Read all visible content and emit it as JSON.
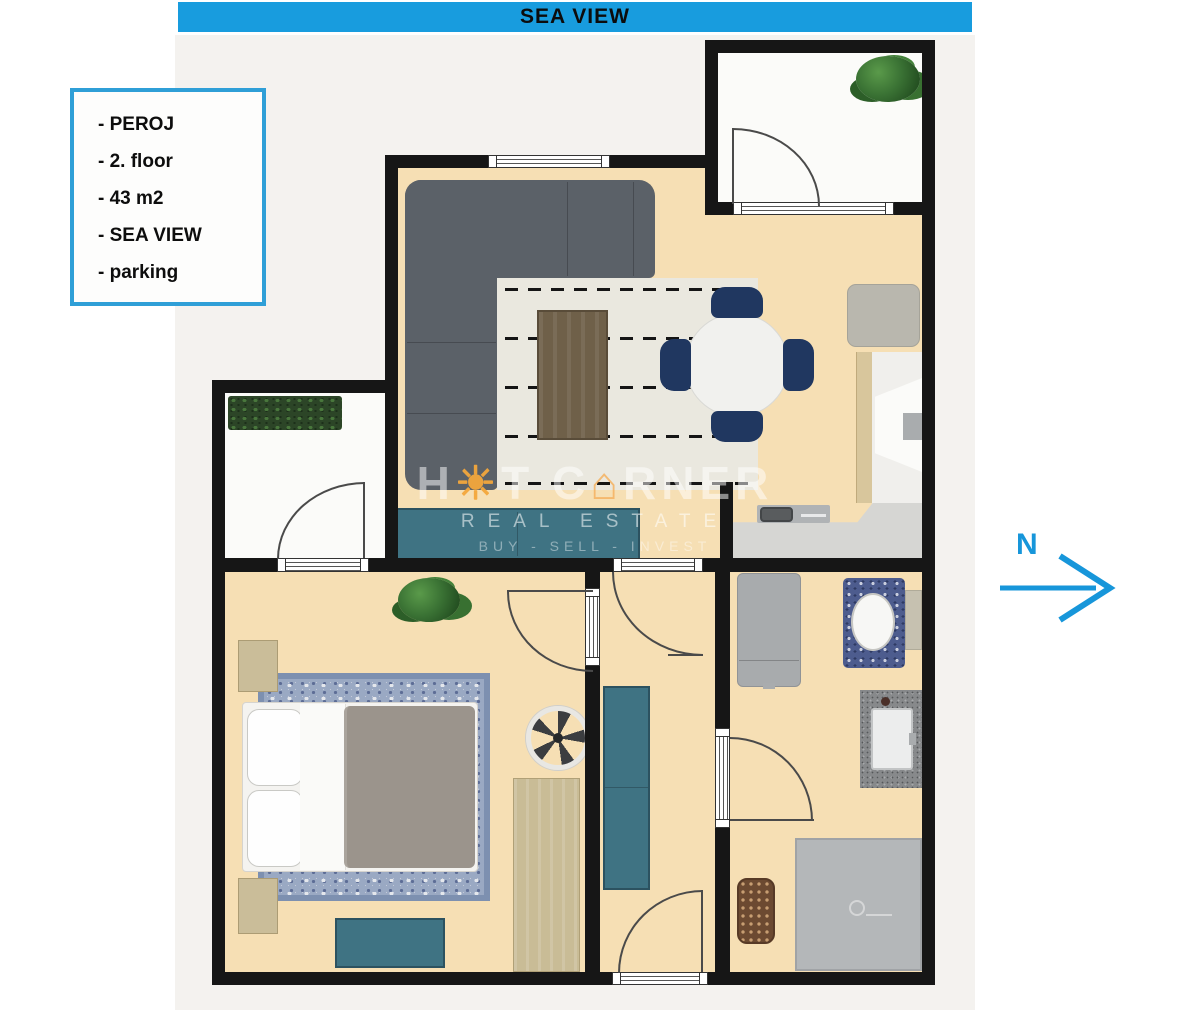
{
  "banner": {
    "label": "SEA VIEW"
  },
  "info_box": {
    "items": [
      "- PEROJ",
      "- 2. floor",
      "- 43 m2",
      "- SEA VIEW",
      "- parking"
    ]
  },
  "compass": {
    "label": "N"
  },
  "watermark": {
    "p1": "H",
    "p2": "T C",
    "p3": "RNER",
    "line2": "REAL ESTATE",
    "line3": "BUY - SELL - INVEST"
  },
  "colors": {
    "banner_blue": "#189cde",
    "accent_blue": "#1796da",
    "info_border": "#2f9fd7",
    "wall_black": "#161616",
    "floor_beige": "#f6dfb4",
    "terrace_white": "#fbfbf9",
    "sofa_gray": "#5b6168",
    "teal_furniture": "#3f7383",
    "navy_chair": "#203760",
    "coffee_table_wood": "#6f6049",
    "blanket_gray": "#9b948c",
    "bedroom_rug_blue": "#9aa9c3",
    "kitchen_wood": "#d8c69c",
    "appliance_gray": "#a8abad",
    "shower_gray": "#b4b7b9",
    "plant_green": "#3a7234",
    "watermark_orange": "#f3a63c"
  }
}
